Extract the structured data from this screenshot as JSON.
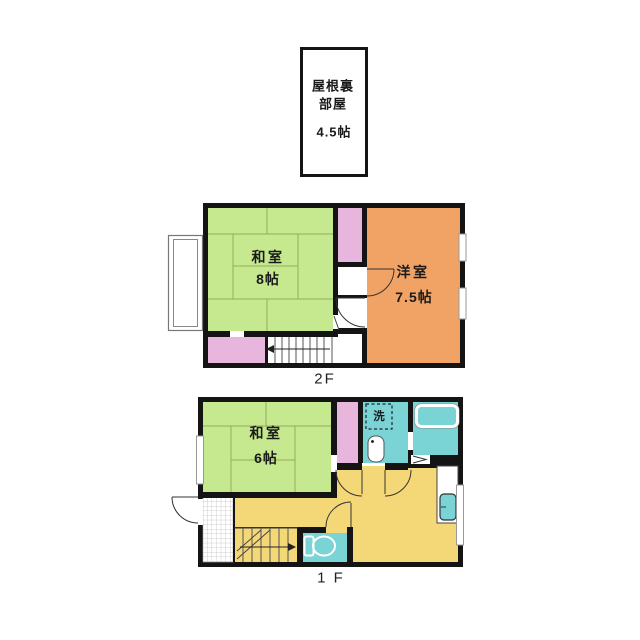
{
  "colors": {
    "wall": "#141414",
    "tatami": "#c6e88e",
    "tatami-line": "#94ab5c",
    "closet-pink": "#e8b5dd",
    "western-orange": "#f1a366",
    "ldk-yellow": "#f4d877",
    "wet-teal": "#7ad3d5",
    "line": "#333333",
    "window": "#999999"
  },
  "attic": {
    "name_line1": "屋根裏",
    "name_line2": "部屋",
    "size": "4.5帖"
  },
  "floor2": {
    "label": "2F",
    "rooms": {
      "washitsu": {
        "name": "和室",
        "size": "8帖"
      },
      "youshitsu": {
        "name": "洋室",
        "size": "7.5帖"
      }
    }
  },
  "floor1": {
    "label": "1 F",
    "rooms": {
      "washitsu": {
        "name": "和室",
        "size": "6帖"
      },
      "laundry": {
        "name": "洗"
      }
    }
  }
}
